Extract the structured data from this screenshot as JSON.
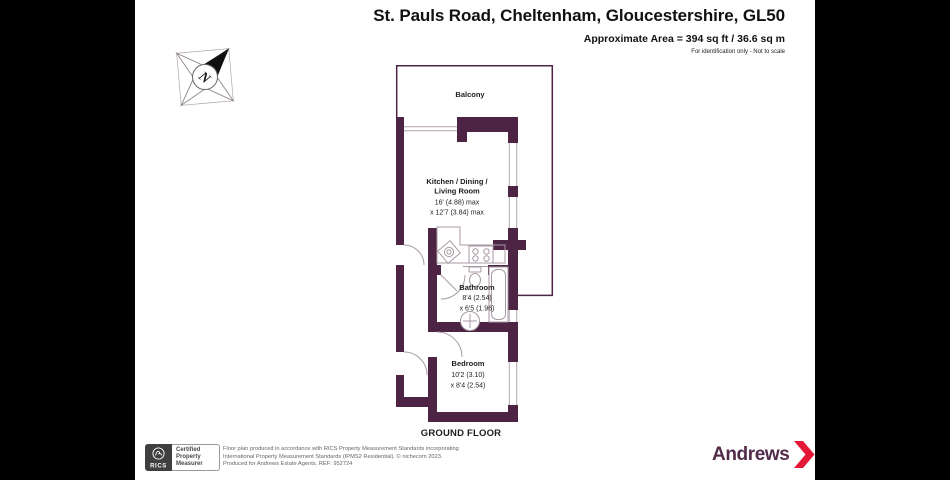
{
  "header": {
    "address": "St. Pauls Road, Cheltenham, Gloucestershire, GL50",
    "area": "Approximate Area = 394 sq ft / 36.6 sq m",
    "note": "For identification only - Not to scale"
  },
  "compass": {
    "north_label": "N"
  },
  "plan": {
    "balcony_label": "Balcony",
    "kitchen": {
      "name_line1": "Kitchen / Dining /",
      "name_line2": "Living Room",
      "dim_line1": "16' (4.88) max",
      "dim_line2": "x 12'7 (3.84) max"
    },
    "bathroom": {
      "name": "Bathroom",
      "dim_line1": "8'4 (2.54)",
      "dim_line2": "x 6'5 (1.96)"
    },
    "bedroom": {
      "name": "Bedroom",
      "dim_line1": "10'2 (3.10)",
      "dim_line2": "x 8'4 (2.54)"
    },
    "floor_label": "GROUND FLOOR"
  },
  "footer": {
    "rics": {
      "abbr": "RICS",
      "cert_line1": "Certified",
      "cert_line2": "Property",
      "cert_line3": "Measurer"
    },
    "disclaimer_line1": "Floor plan produced in accordance with RICS Property Measurement Standards incorporating",
    "disclaimer_line2": "International Property Measurement Standards (IPMS2 Residential).   © nichecom 2023.",
    "disclaimer_line3": "Produced for Andrews Estate Agents.   REF:  952724",
    "brand": {
      "name": "Andrews"
    }
  },
  "colors": {
    "wall": "#4d2444",
    "brand_purple": "#522a4a",
    "brand_red": "#e31837",
    "letterbox": "#000000"
  }
}
